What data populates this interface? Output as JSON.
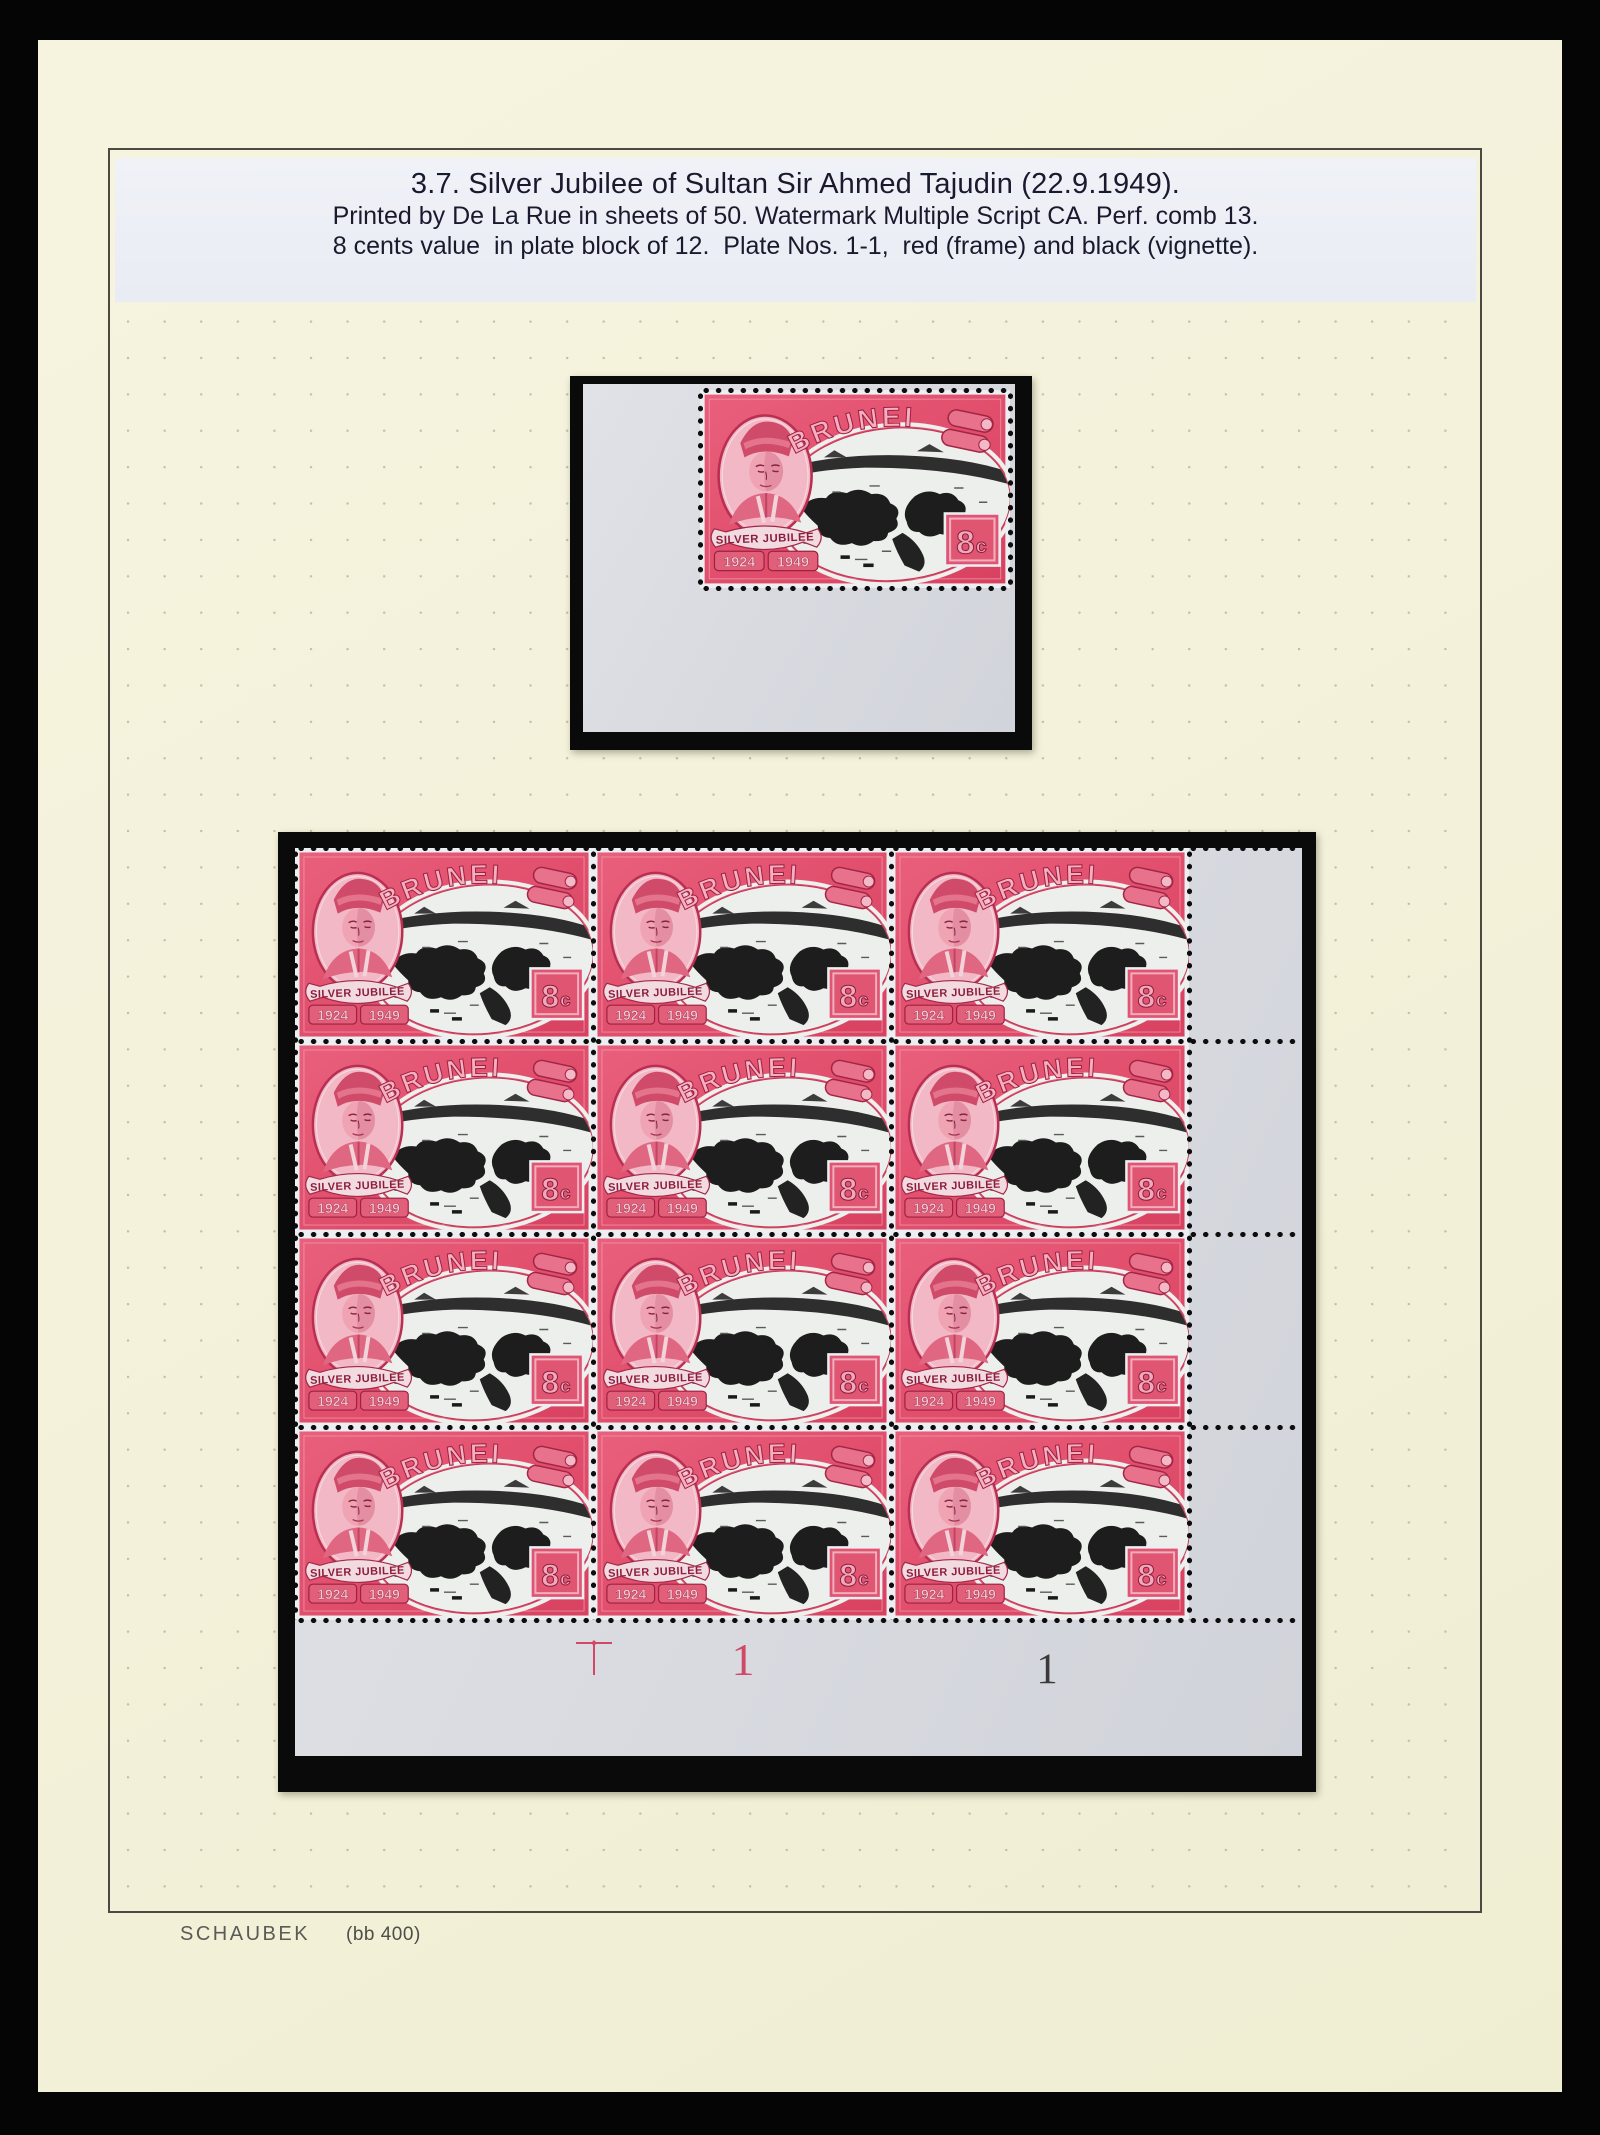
{
  "header": {
    "title": "3.7. Silver Jubilee of Sultan Sir Ahmed Tajudin (22.9.1949).",
    "line1": "Printed by De La Rue in sheets of 50. Watermark Multiple Script CA. Perf. comb 13.",
    "line2": "8 cents value  in plate block of 12.  Plate Nos. 1-1,  red (frame) and black (vignette)."
  },
  "stamp": {
    "country": "BRUNEI",
    "ribbon": "SILVER JUBILEE",
    "year_left": "1924",
    "year_right": "1949",
    "value_digit": "8",
    "value_cent": "c"
  },
  "plate_block": {
    "rows": 4,
    "cols": 3,
    "marks": [
      {
        "type": "guide-cross",
        "text": "",
        "color": "#d04a68"
      },
      {
        "type": "plate-number",
        "text": "1",
        "color": "#d04a68"
      },
      {
        "type": "plate-number",
        "text": "1",
        "color": "#3a3a3a"
      }
    ]
  },
  "footer": {
    "brand": "SCHAUBEK",
    "ref": "(bb 400)"
  },
  "colors": {
    "page_cream": "#f3f1d9",
    "stamp_carmine": "#e14f6d",
    "selvage_gray": "#dadce2",
    "mount_black": "#0a0a0a",
    "plate_number_red": "#d04a68",
    "plate_number_black": "#3a3a3a"
  }
}
